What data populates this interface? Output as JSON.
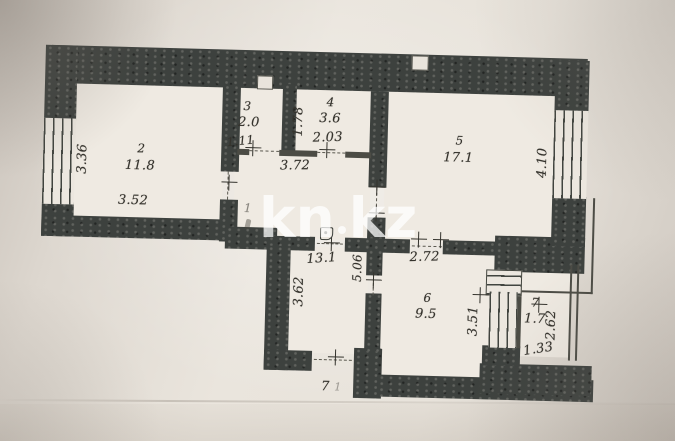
{
  "document": {
    "type": "apartment floor plan scan"
  },
  "watermark": {
    "text": "kn.kz",
    "left": "kn",
    "right": "kz"
  },
  "colors": {
    "wall_dark": "#3d413e",
    "paper": "#e9e4dc",
    "ink": "#35332d",
    "watermark": "#ffffff"
  },
  "rooms": [
    {
      "id": "hall",
      "number": "1",
      "area": "13.1"
    },
    {
      "id": "room2",
      "number": "2",
      "area": "11.8"
    },
    {
      "id": "room3",
      "number": "3",
      "area": "2.0"
    },
    {
      "id": "room4",
      "number": "4",
      "area": "3.6"
    },
    {
      "id": "room5",
      "number": "5",
      "area": "17.1"
    },
    {
      "id": "kitchen",
      "number": "6",
      "area": "9.5"
    },
    {
      "id": "room7",
      "number": "7",
      "area": "1.7"
    }
  ],
  "dimensions": {
    "room2_v": "3.36",
    "room2_h": "3.52",
    "room3_w": "1.11",
    "room4_v": "1.78",
    "room4_h": "2.03",
    "corridor_w": "3.72",
    "room5_v": "4.10",
    "hall_v": "3.62",
    "hall_v2": "5.06",
    "kitchen_h": "2.72",
    "kitchen_v": "3.51",
    "room7_v": "2.62",
    "room7_h": "1.33"
  },
  "door_mark": {
    "label": "7",
    "sub": "1"
  }
}
